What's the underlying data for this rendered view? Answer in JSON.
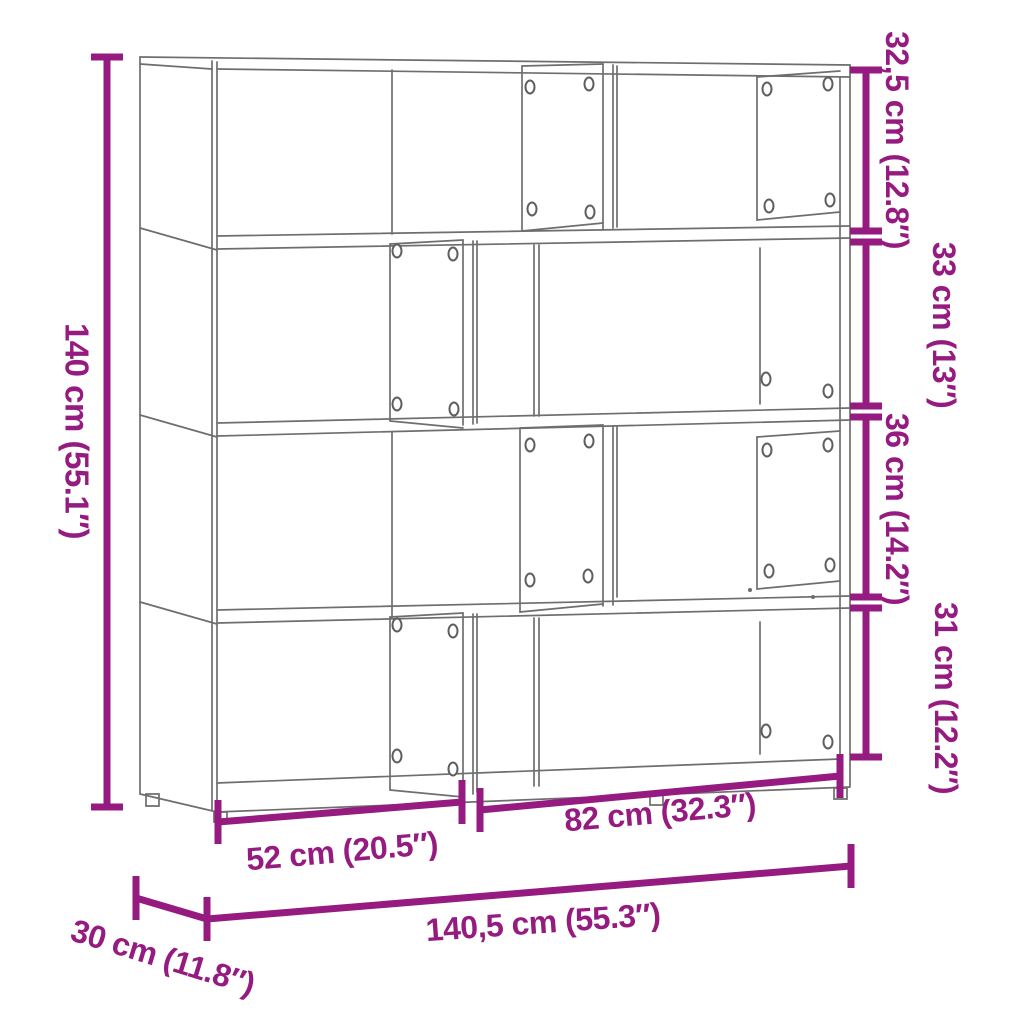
{
  "diagram": {
    "subject": "4-tier corner bookcase line drawing with dimension annotations",
    "colors": {
      "dimension_accent": "#951b81",
      "drawing_lines": "#6e6e6e",
      "background": "#ffffff"
    }
  },
  "dims": {
    "height": {
      "label": "140 cm (55.1″)",
      "cm": "140",
      "inches": "55.1"
    },
    "tier1": {
      "label": "32,5 cm (12.8″)",
      "cm": "32,5",
      "inches": "12.8"
    },
    "tier2": {
      "label": "33 cm (13″)",
      "cm": "33",
      "inches": "13"
    },
    "tier3": {
      "label": "36 cm (14.2″)",
      "cm": "36",
      "inches": "14.2"
    },
    "tier4": {
      "label": "31 cm (12.2″)",
      "cm": "31",
      "inches": "12.2"
    },
    "width_left": {
      "label": "52 cm (20.5″)",
      "cm": "52",
      "inches": "20.5"
    },
    "width_right": {
      "label": "82 cm (32.3″)",
      "cm": "82",
      "inches": "32.3"
    },
    "width_total": {
      "label": "140,5 cm (55.3″)",
      "cm": "140,5",
      "inches": "55.3"
    },
    "depth": {
      "label": "30 cm (11.8″)",
      "cm": "30",
      "inches": "11.8"
    }
  }
}
